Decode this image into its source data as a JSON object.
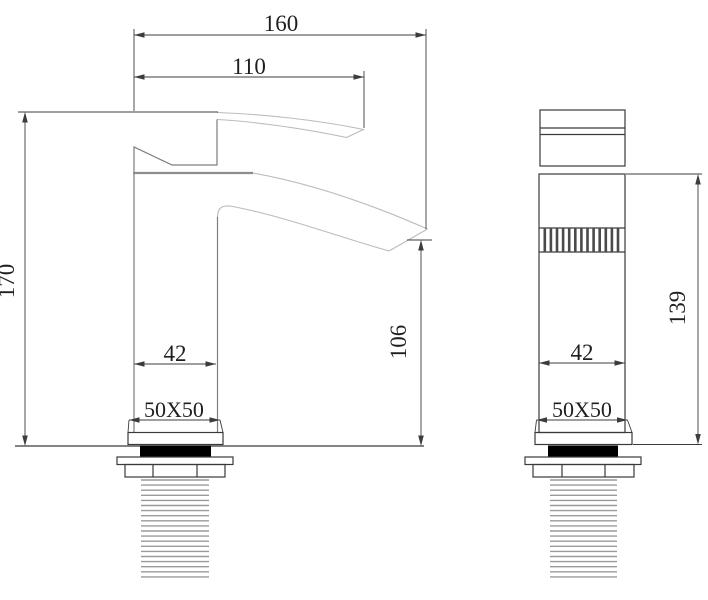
{
  "drawing": {
    "description": "Basin waterfall faucet technical dimension drawing with front view and side view",
    "views": {
      "front": {
        "title": "front-view",
        "dimensions": {
          "overall_width": "160",
          "spout_projection": "110",
          "overall_height": "170",
          "body_width": "42",
          "base_plate": "50X50",
          "spout_height": "106"
        }
      },
      "side": {
        "title": "side-view",
        "dimensions": {
          "body_depth": "42",
          "base_plate": "50X50",
          "body_height": "139"
        }
      }
    },
    "colors": {
      "background": "#ffffff",
      "faucet_outline": "#bcbcbc",
      "detail_line": "#7d7d7d",
      "dimension_line": "#3c3c3c",
      "text": "#1f1f1f",
      "gasket_fill": "#000000"
    }
  }
}
